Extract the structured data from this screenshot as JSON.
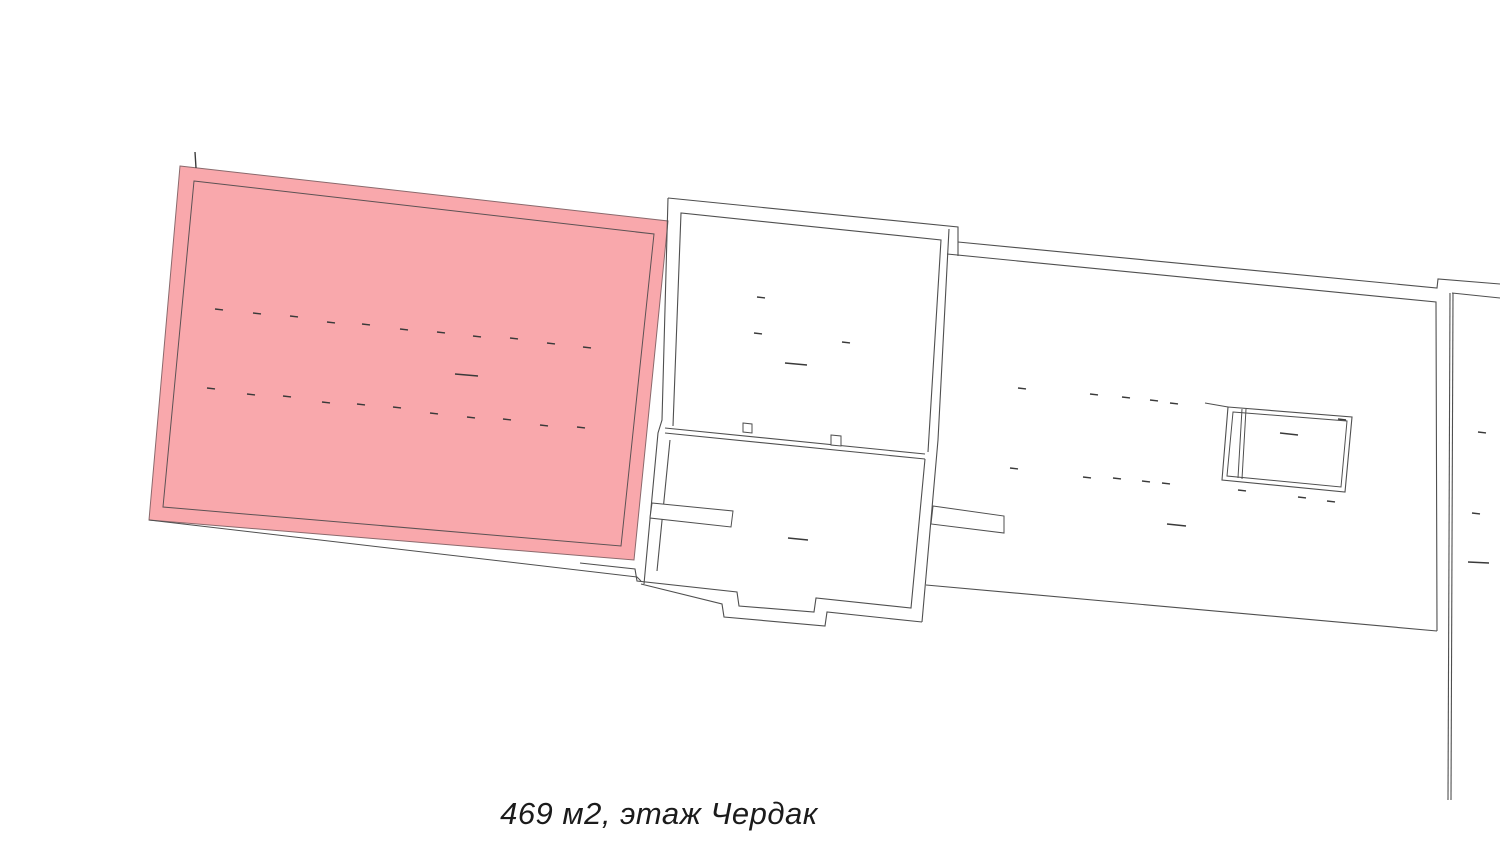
{
  "canvas": {
    "width": 1500,
    "height": 845,
    "background": "#ffffff"
  },
  "caption": {
    "text": "469 м2, этаж Чердак"
  },
  "colors": {
    "highlight_fill": "#F9A8AC",
    "highlight_edge": "#8a696c",
    "wall_line": "#4f4f4f",
    "tick": "#3a3a3a"
  },
  "plan": {
    "highlight_room": {
      "fill_points": "180,166 668,221 634,560 149,520",
      "inner_points": "194,181 654,234 621,546 163,507",
      "bottom_wall_line": "149,520 637,577 641,581"
    },
    "walls": [
      "668,198 662,420 658,433 644,584",
      "668,198 958,227 958,242",
      "958,242 1437,288 1438,279 1500,284",
      "949,229 938,440 922,622",
      "673,426 681,213 941,240 928,452",
      "665,428 925,454",
      "665,433 925,459",
      "670,440 657,571",
      "580,563 635,569 637,581 737,592 739,606 814,612 816,598 911,608 925,459",
      "641,584 722,604 724,617 825,626 827,612 922,622",
      "947,254 1436,302 1437,631",
      "958,242 958,256",
      "926,585 1437,631",
      "1450,293 1448,800",
      "1453,293 1451,800",
      "1452,293 1500,298",
      "1205,403 1228,407"
    ],
    "piers": [
      "652,503 733,511 731,527 650,518",
      "933,506 1004,516 1004,533 931,524"
    ],
    "shaft": {
      "outer": "1228,407 1352,417 1345,492 1222,480",
      "inner": "1233,412 1347,421 1341,487 1227,476",
      "divider_lines": [
        "1242,409 1238,478",
        "1246,409 1242,479"
      ]
    },
    "bumps": [
      "743,423 752,424 752,433 743,432",
      "831,435 841,436 841,446 831,445"
    ],
    "ticks": [
      [
        215,
        309
      ],
      [
        253,
        313
      ],
      [
        290,
        316
      ],
      [
        327,
        322
      ],
      [
        362,
        324
      ],
      [
        400,
        329
      ],
      [
        437,
        332
      ],
      [
        473,
        336
      ],
      [
        510,
        338
      ],
      [
        547,
        343
      ],
      [
        583,
        347
      ],
      [
        207,
        388
      ],
      [
        247,
        394
      ],
      [
        283,
        396
      ],
      [
        322,
        402
      ],
      [
        357,
        404
      ],
      [
        393,
        407
      ],
      [
        430,
        413
      ],
      [
        467,
        417
      ],
      [
        503,
        419
      ],
      [
        540,
        425
      ],
      [
        577,
        427
      ],
      [
        757,
        297
      ],
      [
        754,
        333
      ],
      [
        842,
        342
      ],
      [
        1018,
        388
      ],
      [
        1090,
        394
      ],
      [
        1122,
        397
      ],
      [
        1150,
        400
      ],
      [
        1170,
        403
      ],
      [
        1338,
        419
      ],
      [
        1010,
        468
      ],
      [
        1083,
        477
      ],
      [
        1113,
        478
      ],
      [
        1142,
        481
      ],
      [
        1162,
        483
      ],
      [
        1238,
        490
      ],
      [
        1298,
        497
      ],
      [
        1327,
        501
      ],
      [
        1478,
        432
      ],
      [
        1472,
        513
      ]
    ],
    "dashes": [
      [
        455,
        374,
        478,
        376
      ],
      [
        785,
        363,
        807,
        365
      ],
      [
        788,
        538,
        808,
        540
      ],
      [
        1167,
        524,
        1186,
        526
      ],
      [
        1280,
        433,
        1298,
        435
      ],
      [
        1468,
        562,
        1489,
        563
      ],
      [
        195,
        152,
        196,
        168
      ]
    ]
  }
}
